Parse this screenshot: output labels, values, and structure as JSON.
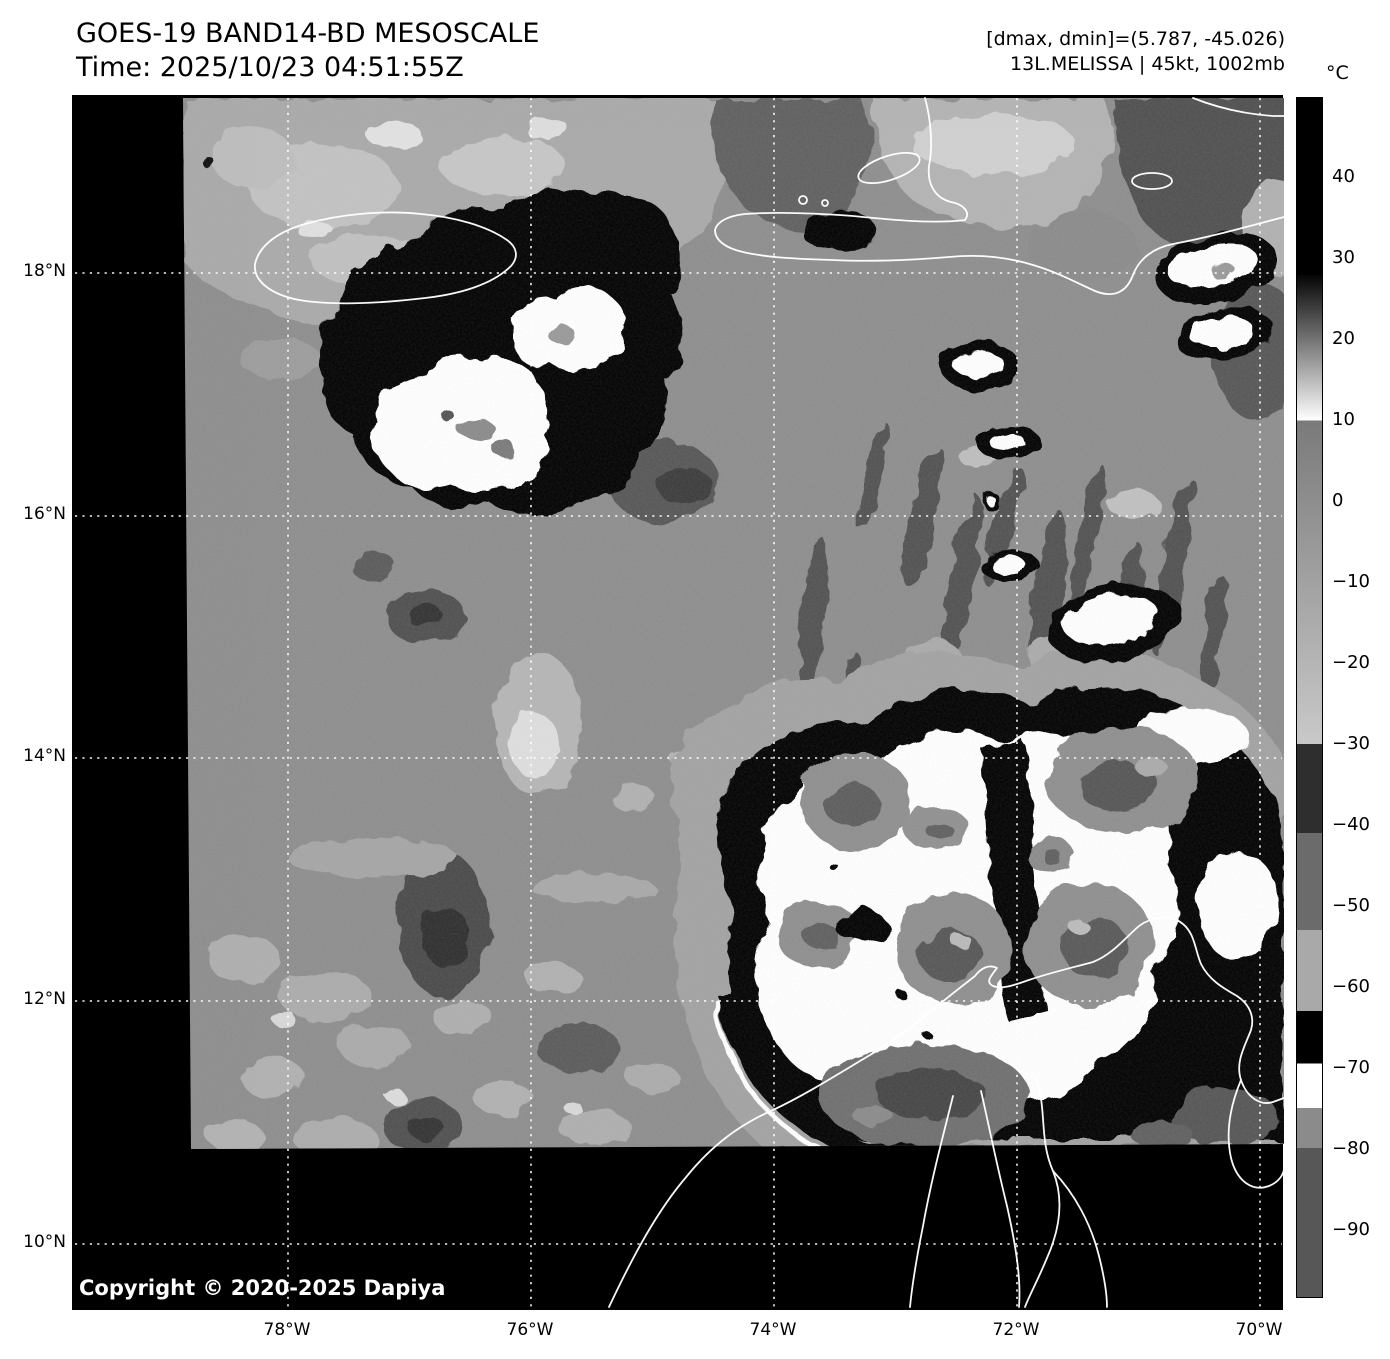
{
  "header": {
    "title_line1": "GOES-19 BAND14-BD MESOSCALE",
    "title_line2": "Time: 2025/10/23 04:51:55Z",
    "info_line1": "[dmax, dmin]=(5.787, -45.026)",
    "info_line2": "13L.MELISSA | 45kt, 1002mb"
  },
  "colorbar": {
    "unit": "°C",
    "range_top": 49.9,
    "range_bottom": -98.4,
    "ticks": [
      {
        "value": 40,
        "label": "40"
      },
      {
        "value": 30,
        "label": "30"
      },
      {
        "value": 20,
        "label": "20"
      },
      {
        "value": 10,
        "label": "10"
      },
      {
        "value": 0,
        "label": "0"
      },
      {
        "value": -10,
        "label": "−10"
      },
      {
        "value": -20,
        "label": "−20"
      },
      {
        "value": -30,
        "label": "−30"
      },
      {
        "value": -40,
        "label": "−40"
      },
      {
        "value": -50,
        "label": "−50"
      },
      {
        "value": -60,
        "label": "−60"
      },
      {
        "value": -70,
        "label": "−70"
      },
      {
        "value": -80,
        "label": "−80"
      },
      {
        "value": -90,
        "label": "−90"
      }
    ],
    "segments": [
      {
        "from": 49.9,
        "to": 28,
        "color": "#000000"
      },
      {
        "from": 28,
        "to": 10,
        "gradient": true,
        "color_start": "#050505",
        "color_end": "#ffffff"
      },
      {
        "from": 10,
        "to": -30,
        "gradient": true,
        "color_start": "#7a7a7a",
        "color_end": "#c9c9c9"
      },
      {
        "from": -30,
        "to": -41,
        "color": "#2e2e2e"
      },
      {
        "from": -41,
        "to": -53,
        "color": "#6b6b6b"
      },
      {
        "from": -53,
        "to": -63,
        "color": "#a9a9a9"
      },
      {
        "from": -63,
        "to": -69.5,
        "color": "#000000"
      },
      {
        "from": -69.5,
        "to": -75,
        "color": "#ffffff"
      },
      {
        "from": -75,
        "to": -80,
        "color": "#8b8b8b"
      },
      {
        "from": -80,
        "to": -98.4,
        "color": "#575757"
      }
    ]
  },
  "map": {
    "lat_labels": [
      "18°N",
      "16°N",
      "14°N",
      "12°N",
      "10°N"
    ],
    "lon_labels": [
      "78°W",
      "76°W",
      "74°W",
      "72°W",
      "70°W"
    ],
    "copyright": "Copyright © 2020-2025 Dapiya"
  }
}
